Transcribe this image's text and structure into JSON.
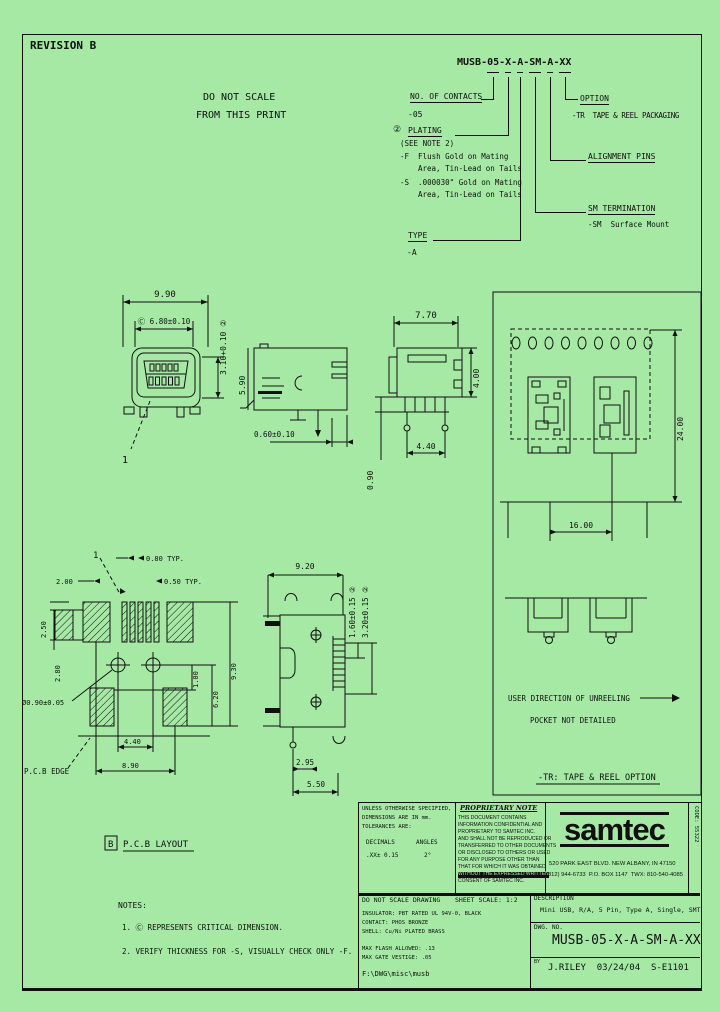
{
  "colors": {
    "background": "#a5e9a5",
    "ink": "#101010"
  },
  "sheet": {
    "revision": "REVISION B",
    "warning_line1": "DO NOT SCALE",
    "warning_line2": "FROM THIS PRINT"
  },
  "part_number": {
    "value": "MUSB-05-X-A-SM-A-XX",
    "contacts_label": "NO. OF CONTACTS",
    "contacts_value": "-05",
    "plating_flag": "②",
    "plating_label": "PLATING",
    "plating_see_note": "(SEE NOTE 2)",
    "plating_f": "-F  Flush Gold on Mating",
    "plating_f2": "Area, Tin-Lead on Tails",
    "plating_s": "-S  .000030\" Gold on Mating",
    "plating_s2": "Area, Tin-Lead on Tails",
    "type_label": "TYPE",
    "type_value": "-A",
    "option_label": "OPTION",
    "option_value": "-TR  TAPE & REEL PACKAGING",
    "alignment_label": "ALIGNMENT PINS",
    "termination_label": "SM TERMINATION",
    "termination_value": "-SM  Surface Mount"
  },
  "views": {
    "front": {
      "width": "9.90",
      "opening": "Ⓒ 6.80±0.10",
      "height": "3.10+0.10 ②",
      "pin1": "1"
    },
    "side": {
      "height": "5.90",
      "tail": "0.60±0.10"
    },
    "end": {
      "width": "7.70",
      "body": "4.00",
      "pins": "4.40",
      "standoff": "0.90"
    },
    "bottom": {
      "width": "9.20",
      "tab": "1.60±0.15 ②",
      "slot": "3.20±0.15 ②",
      "pin": "2.95",
      "pitch": "5.50"
    }
  },
  "pcb": {
    "pin1": "1",
    "pitch": "0.80 TYP.",
    "offset": "2.00",
    "pad_width": "0.50 TYP.",
    "pad_len": "2.50",
    "side": "2.80",
    "hole": "Ø0.90±0.05",
    "r1": "1.00",
    "r2": "6.20",
    "r3": "9.30",
    "span": "4.40",
    "total": "8.90",
    "edge_label": "P.C.B EDGE",
    "view_flag": "B",
    "view_label": "P.C.B LAYOUT"
  },
  "tape": {
    "height": "24.00",
    "pitch": "16.00",
    "unreel": "USER DIRECTION OF UNREELING",
    "pocket": "POCKET NOT DETAILED",
    "caption": "-TR:  TAPE & REEL OPTION"
  },
  "notes": {
    "title": "NOTES:",
    "n1": "1. Ⓒ REPRESENTS CRITICAL DIMENSION.",
    "n2": "2. VERIFY THICKNESS FOR -S, VISUALLY CHECK ONLY -F."
  },
  "title_block": {
    "tol_line1": "UNLESS OTHERWISE SPECIFIED,",
    "tol_line2": "DIMENSIONS ARE IN mm.",
    "tol_line3": "TOLERANCES ARE:",
    "decimals_label": "DECIMALS",
    "decimals_value": ".XX± 0.15",
    "angles_label": "ANGLES",
    "angles_value": "2°",
    "prop_title": "PROPRIETARY NOTE",
    "prop_lines": [
      "THIS DOCUMENT CONTAINS",
      "INFORMATION CONFIDENTIAL AND",
      "PROPRIETARY TO SAMTEC INC.",
      "AND SHALL NOT BE REPRODUCED OR",
      "TRANSFERRED TO OTHER DOCUMENTS",
      "OR DISCLOSED TO OTHERS OR USED",
      "FOR ANY PURPOSE OTHER THAN",
      "THAT FOR WHICH IT WAS OBTAINED",
      "WITHOUT THE EXPRESSED WRITTEN",
      "CONSENT OF SAMTEC INC."
    ],
    "logo": "samtec",
    "address1": "520 PARK EAST BLVD. NEW ALBANY, IN 47150",
    "address2": "(812) 944-6733  P.O. BOX 1147  TWX: 810-540-4085",
    "code": "CODE: 55322",
    "no_scale": "DO NOT SCALE DRAWING",
    "material1": "INSULATOR: PBT RATED UL 94V-0, BLACK",
    "material2": "CONTACT: PHOS BRONZE",
    "material3": "SHELL: Cu/Ni PLATED BRASS",
    "flash1": "MAX FLASH ALLOWED: .13",
    "flash2": "MAX GATE VESTIGE: .05",
    "file_path": "F:\\DWG\\misc\\musb",
    "sheet_scale": "SHEET SCALE: 1:2",
    "description_label": "DESCRIPTION",
    "description": "Mini USB, R/A, 5 Pin, Type A, Single, SMT",
    "dwg_label": "DWG. NO.",
    "dwg_no": "MUSB-05-X-A-SM-A-XX",
    "by_label": "BY",
    "by_value": "J.RILEY  03/24/04  S-E1101"
  }
}
